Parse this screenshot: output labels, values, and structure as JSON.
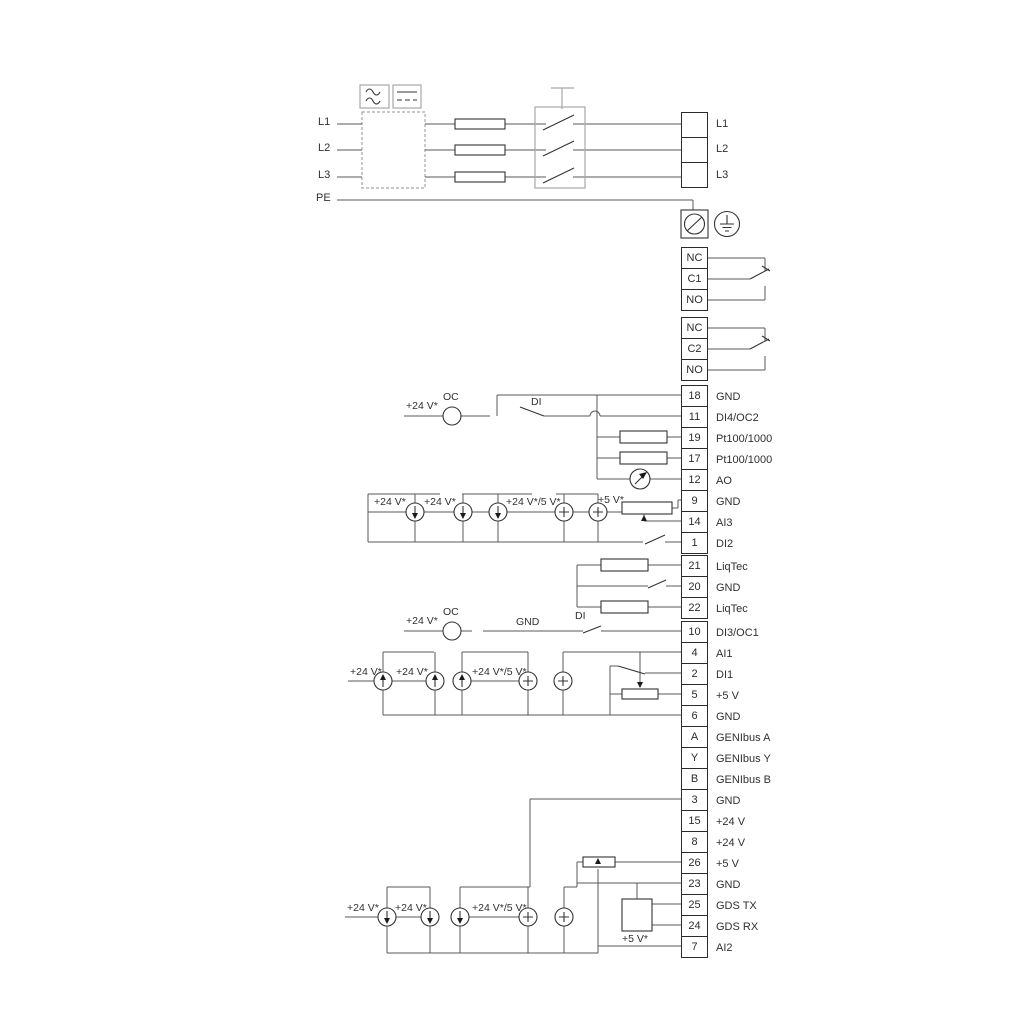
{
  "diagram": {
    "colors": {
      "wire": "#595959",
      "component": "#333333",
      "muted": "#a8a8a8",
      "text": "#303030"
    },
    "power": {
      "in": [
        "L1",
        "L2",
        "L3",
        "PE"
      ],
      "out": [
        "L1",
        "L2",
        "L3"
      ]
    },
    "relay1": [
      "NC",
      "C1",
      "NO"
    ],
    "relay2": [
      "NC",
      "C2",
      "NO"
    ],
    "io1": {
      "pins": [
        "18",
        "11",
        "19",
        "17",
        "12",
        "9",
        "14",
        "1"
      ],
      "labels": [
        "GND",
        "DI4/OC2",
        "Pt100/1000",
        "Pt100/1000",
        "AO",
        "GND",
        "AI3",
        "DI2"
      ],
      "ann": {
        "v24": "+24 V*",
        "oc": "OC",
        "di": "DI",
        "v24a": "+24 V*",
        "v24b": "+24 V*",
        "v245": "+24 V*/5 V*",
        "v5": "+5 V*"
      }
    },
    "liqtec": {
      "pins": [
        "21",
        "20",
        "22"
      ],
      "labels": [
        "LiqTec",
        "GND",
        "LiqTec"
      ]
    },
    "io2": {
      "pins": [
        "10",
        "4",
        "2",
        "5",
        "6",
        "A",
        "Y",
        "B"
      ],
      "labels": [
        "DI3/OC1",
        "AI1",
        "DI1",
        "+5 V",
        "GND",
        "GENIbus A",
        "GENIbus Y",
        "GENIbus B"
      ],
      "ann": {
        "v24": "+24 V*",
        "oc": "OC",
        "gnd": "GND",
        "di": "DI",
        "v24a": "+24 V*",
        "v24b": "+24 V*",
        "v245": "+24 V*/5 V*"
      }
    },
    "io3": {
      "pins": [
        "3",
        "15",
        "8",
        "26",
        "23",
        "25",
        "24",
        "7"
      ],
      "labels": [
        "GND",
        "+24 V",
        "+24 V",
        "+5 V",
        "GND",
        "GDS TX",
        "GDS RX",
        "AI2"
      ],
      "ann": {
        "v24a": "+24 V*",
        "v24b": "+24 V*",
        "v245": "+24 V*/5 V*",
        "v5": "+5 V*"
      }
    }
  }
}
